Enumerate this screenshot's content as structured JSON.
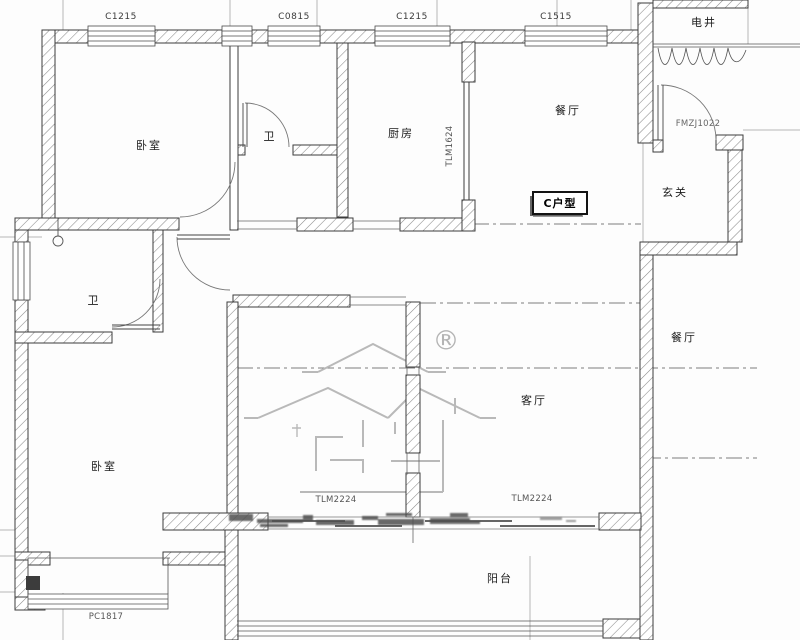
{
  "meta": {
    "drawing_type": "residential floor plan (CAD)",
    "unit_type_label": "C户型"
  },
  "colors": {
    "wall_line": "#3c3c3c",
    "hatch": "#8a8a8a",
    "thin_line": "#777777",
    "grid_line": "#999999",
    "watermark": "#b9b9b9",
    "smudge": "#4f4f4f"
  },
  "labels": {
    "win1": "C1215",
    "win2": "C0815",
    "win3": "C1215",
    "win4": "C1515",
    "shaft": "电井",
    "bedroom1": "卧室",
    "bath1": "卫",
    "kitchen": "厨房",
    "dining": "餐厅",
    "door_kitchen": "TLM1624",
    "door_entry": "FMZJ1022",
    "foyer": "玄关",
    "unit_type": "C户型",
    "bath2": "卫",
    "dining_right": "餐厅",
    "living": "客厅",
    "bedroom2": "卧室",
    "door_balcony_left": "TLM2224",
    "door_balcony_right": "TLM2224",
    "balcony": "阳台",
    "bay_window": "PC1817",
    "registered_mark": "®"
  }
}
